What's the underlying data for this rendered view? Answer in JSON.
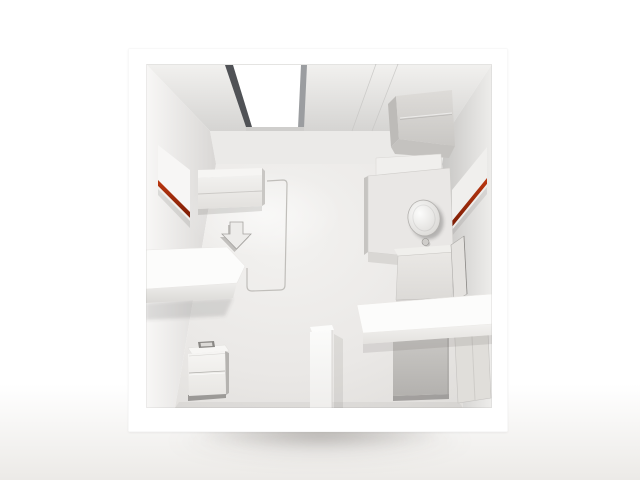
{
  "scene": {
    "description": "Cutaway 3D render viewed from above of a white miniature studio-apartment model: ceiling with bright skylight and ceiling-mounted unit, red accent light strips on the left and right walls, wall bed, floor arrow decal, door-swing outline on the floor, left partition wall, two-drawer nightstand, bottom partition stub, toilet on an L-shaped platform, shower box, white storage slab, gray wardrobe box and an entry door with vent, all in white and light gray with soft shadow under the model.",
    "objects": [
      "room-model-frame",
      "ceiling",
      "skylight",
      "ceiling-unit-box",
      "back-wall",
      "left-wall",
      "right-wall",
      "floor",
      "left-wall-panel-red-strip",
      "right-wall-panel-red-strip",
      "wall-bed",
      "floor-arrow-decal",
      "door-swing-outline",
      "partition-wall-left",
      "nightstand",
      "partition-stub",
      "toilet-platform",
      "toilet",
      "cistern-panel",
      "shower-box",
      "leaning-panel",
      "right-storage-slab",
      "wardrobe-box",
      "entry-door",
      "door-vent",
      "model-shadow"
    ]
  },
  "palette": {
    "bg": "#ffffff",
    "bg-bottom": "#eceae7",
    "frame": "#ffffff",
    "accent-red": "#bb3710",
    "accent-red-dark": "#7c1d05",
    "ceiling-front": "#f2f1ef",
    "ceiling-back": "#d5d4d2",
    "back-wall": "#ebeae8",
    "skylight-frame": "#505256",
    "skylight-white": "#ffffff",
    "floor-center": "#f3f2f0",
    "floor-edge": "#e0dedb",
    "box-gray": "#c8c6c3",
    "cut-wall-white": "#fcfcfb"
  }
}
